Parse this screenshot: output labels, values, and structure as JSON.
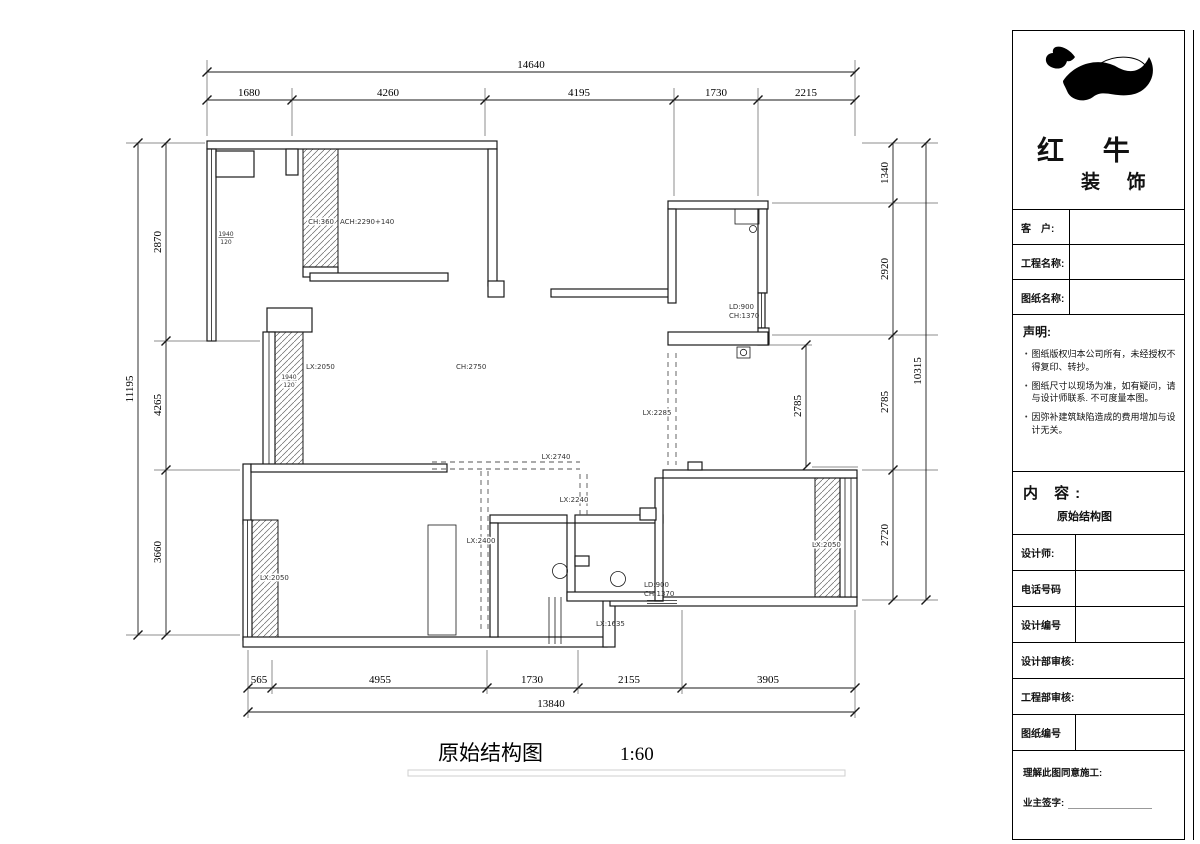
{
  "drawing": {
    "caption": {
      "title": "原始结构图",
      "scale": "1:60"
    },
    "dims": {
      "top": {
        "total": "14640",
        "segments": [
          "1680",
          "4260",
          "4195",
          "1730",
          "2215"
        ]
      },
      "left": {
        "total": "11195",
        "segments": [
          "2870",
          "4265",
          "3660"
        ]
      },
      "right": {
        "total": "10315",
        "segments": [
          "1340",
          "2920",
          "2785",
          "2720"
        ]
      },
      "bottom": {
        "total": "13840",
        "segments": [
          "565",
          "4955",
          "1730",
          "2155",
          "3905"
        ]
      },
      "interior": [
        "2785"
      ]
    },
    "plan_labels": {
      "window_tag_top": "1940",
      "window_tag_bottom": "120",
      "upper_note_prefix": "CH:360",
      "upper_note": "ACH:2290+140",
      "lx2050": "LX:2050",
      "ch2750": "CH:2750",
      "lx2285": "LX:2285",
      "ld900": "LD:900",
      "ch1370": "CH:1370",
      "lx2740": "LX:2740",
      "lx2240": "LX:2240",
      "lx2400": "LX:2400",
      "lx1635": "LX:1635"
    }
  },
  "title_block": {
    "brand": {
      "line1": "红 牛",
      "line2": "装 饰"
    },
    "info_fields": [
      "客　户:",
      "工程名称:",
      "图纸名称:"
    ],
    "statement": {
      "heading": "声明:",
      "items": [
        "图纸版权归本公司所有，未经授权不得复印、转抄。",
        "图纸尺寸以现场为准，如有疑问，请与设计师联系. 不可度量本图。",
        "因弥补建筑缺陷造成的费用增加与设计无关。"
      ]
    },
    "content": {
      "heading": "内 容:",
      "value": "原始结构图"
    },
    "detail_rows": [
      "设计师:",
      "电话号码",
      "设计编号",
      "设计部审核:",
      "工程部审核:",
      "图纸编号"
    ],
    "sign": {
      "line1": "理解此图同意施工:",
      "line2": "业主签字:"
    }
  }
}
